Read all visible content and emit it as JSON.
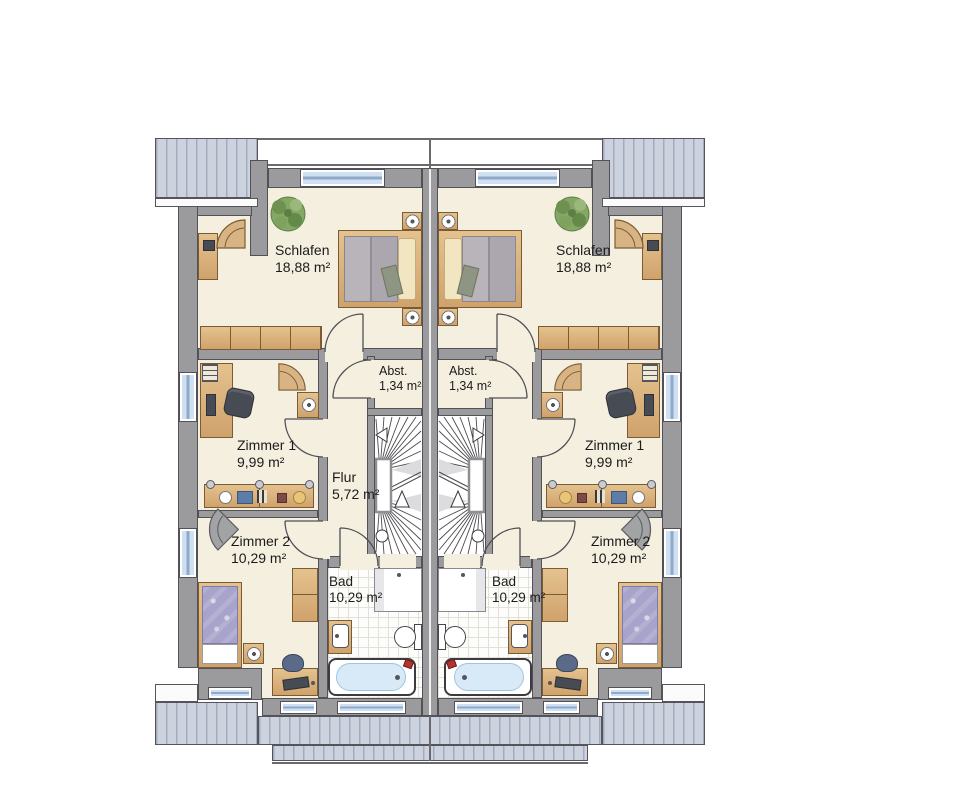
{
  "plan_colors": {
    "wall": "#9b9b9d",
    "wall_outline": "#515157",
    "room_floor": "#f5efe0",
    "roof": "#ccd3df",
    "roof_stripe": "#a3abbc",
    "window_glass": "#cfe0f3",
    "furniture_wood": "#d5ab77",
    "bath_tile": "#fdfdfb",
    "bathtub_water": "#d8eaf7",
    "bed_duvet_gray": "#b4afb5",
    "bed_duvet_purple": "#a7a3ca",
    "plant_green": "#7fa25e"
  },
  "rooms": {
    "schlafen_left": {
      "label": "Schlafen",
      "area": "18,88 m²"
    },
    "schlafen_right": {
      "label": "Schlafen",
      "area": "18,88 m²"
    },
    "zimmer1_left": {
      "label": "Zimmer 1",
      "area": "9,99 m²"
    },
    "zimmer1_right": {
      "label": "Zimmer 1",
      "area": "9,99 m²"
    },
    "zimmer2_left": {
      "label": "Zimmer 2",
      "area": "10,29 m²"
    },
    "zimmer2_right": {
      "label": "Zimmer 2",
      "area": "10,29 m²"
    },
    "flur_left": {
      "label": "Flur",
      "area": "5,72 m²"
    },
    "abstellraum_left": {
      "label": "Abst.",
      "area": "1,34 m²"
    },
    "abstellraum_right": {
      "label": "Abst.",
      "area": "1,34 m²"
    },
    "bad_left": {
      "label": "Bad",
      "area": "10,29 m²"
    },
    "bad_right": {
      "label": "Bad",
      "area": "10,29 m²"
    }
  }
}
